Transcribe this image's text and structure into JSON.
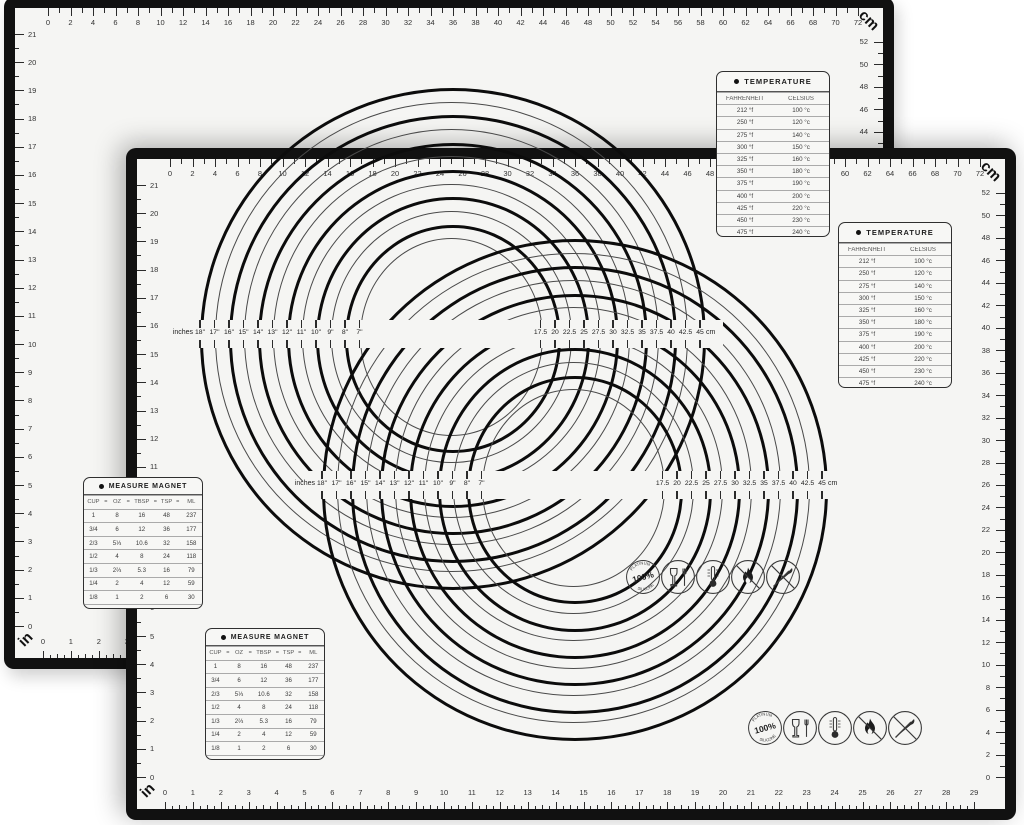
{
  "scene": {
    "background": "#ffffff",
    "mat_surface": "#f5f5f3",
    "mat_border": "#111111"
  },
  "mat": {
    "top_ruler": {
      "unit_label": "cm",
      "start": 0,
      "end": 72,
      "number_step": 2
    },
    "right_ruler": {
      "unit": "cm",
      "start": 52,
      "end": 0,
      "number_step": 2
    },
    "left_ruler": {
      "unit": "in",
      "start": 21,
      "end": 0,
      "number_step": 1
    },
    "bottom_ruler": {
      "unit_label": "in",
      "start": 0,
      "end": 29,
      "number_step": 1
    },
    "temperature_table": {
      "title": "TEMPERATURE",
      "columns": [
        "FAHRENHEIT",
        "CELSIUS"
      ],
      "rows": [
        [
          "212 °f",
          "100 °c"
        ],
        [
          "250 °f",
          "120 °c"
        ],
        [
          "275 °f",
          "140 °c"
        ],
        [
          "300 °f",
          "150 °c"
        ],
        [
          "325 °f",
          "160 °c"
        ],
        [
          "350 °f",
          "180 °c"
        ],
        [
          "375 °f",
          "190 °c"
        ],
        [
          "400 °f",
          "200 °c"
        ],
        [
          "425 °f",
          "220 °c"
        ],
        [
          "450 °f",
          "230 °c"
        ],
        [
          "475 °f",
          "240 °c"
        ],
        [
          "500 °f",
          "260 °c"
        ]
      ]
    },
    "measure_table": {
      "title": "MEASURE MAGNET",
      "columns": [
        "CUP",
        "OZ",
        "TBSP",
        "TSP",
        "ML"
      ],
      "separator": "=",
      "rows": [
        [
          "1",
          "8",
          "16",
          "48",
          "237"
        ],
        [
          "3/4",
          "6",
          "12",
          "36",
          "177"
        ],
        [
          "2/3",
          "5⅓",
          "10.6",
          "32",
          "158"
        ],
        [
          "1/2",
          "4",
          "8",
          "24",
          "118"
        ],
        [
          "1/3",
          "2⅔",
          "5.3",
          "16",
          "79"
        ],
        [
          "1/4",
          "2",
          "4",
          "12",
          "59"
        ],
        [
          "1/8",
          "1",
          "2",
          "6",
          "30"
        ],
        [
          "1/16",
          "1/2",
          "1",
          "3",
          "15"
        ]
      ]
    },
    "circle_labels": {
      "left_unit": "inches",
      "right_unit": "cm",
      "inches_outer_to_inner": [
        "18\"",
        "17\"",
        "16\"",
        "15\"",
        "14\"",
        "13\"",
        "12\"",
        "11\"",
        "10\"",
        "9\"",
        "8\"",
        "7\""
      ],
      "cm_outer_to_inner": [
        "45",
        "42.5",
        "40",
        "37.5",
        "35",
        "32.5",
        "30",
        "27.5",
        "25",
        "22.5",
        "20",
        "17.5"
      ]
    },
    "icons": [
      {
        "name": "silicone-badge-icon",
        "center_text": "100%",
        "arc_top": "PLATINUM",
        "arc_bottom": "SILICONE"
      },
      {
        "name": "food-safe-icon"
      },
      {
        "name": "thermometer-icon"
      },
      {
        "name": "no-open-flame-icon"
      },
      {
        "name": "no-knife-icon"
      }
    ]
  }
}
